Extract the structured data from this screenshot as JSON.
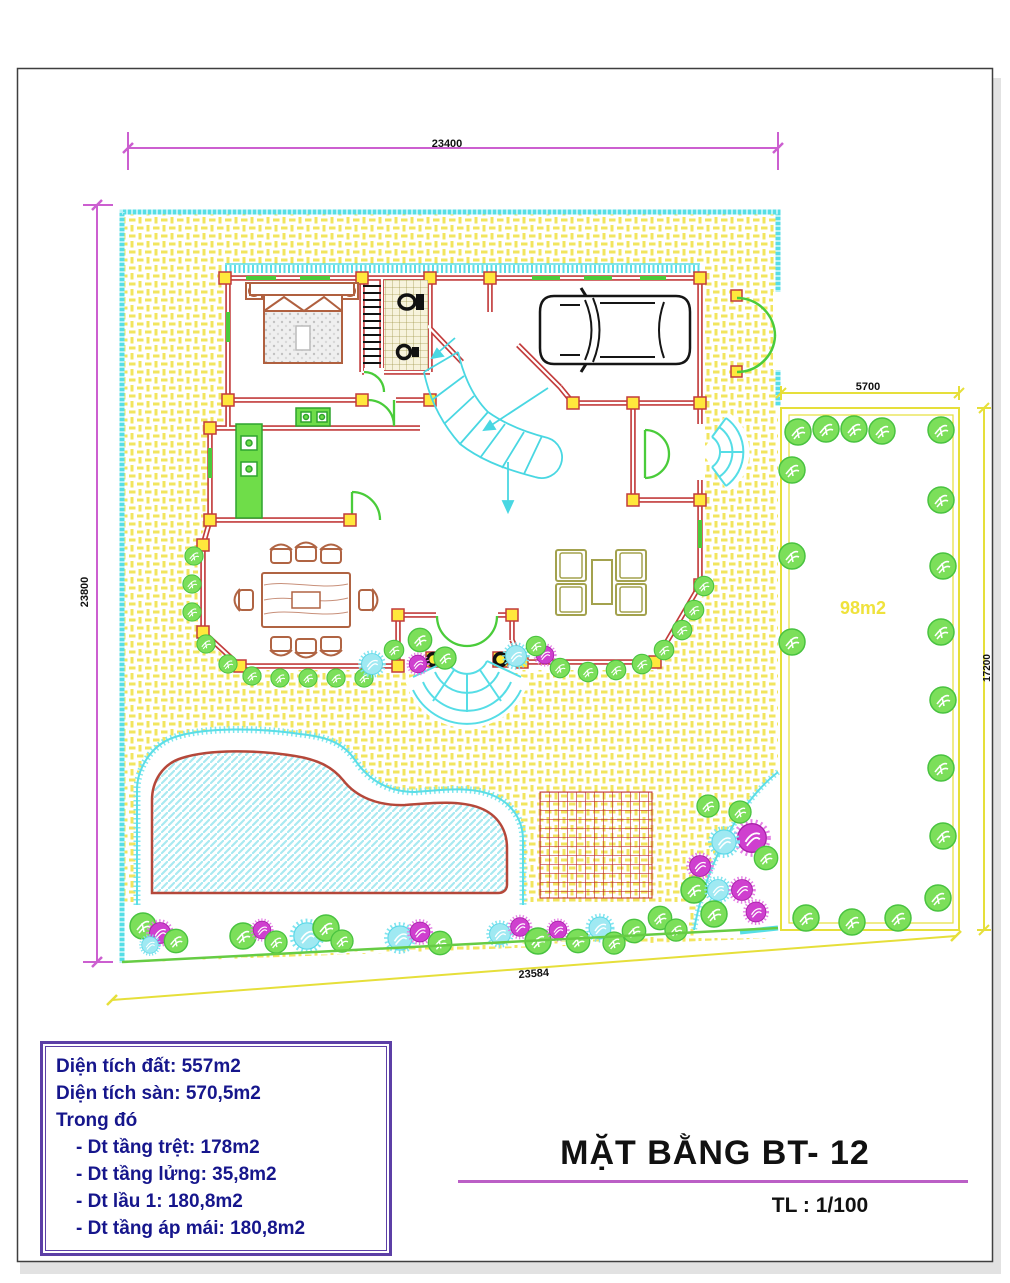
{
  "title_block": {
    "title": "MẶT BẰNG BT- 12",
    "scale": "TL : 1/100"
  },
  "legend": {
    "lines": [
      {
        "text": "Diện tích đất: 557m2",
        "indent": false
      },
      {
        "text": "Diện tích sàn: 570,5m2",
        "indent": false
      },
      {
        "text": "Trong đó",
        "indent": false
      },
      {
        "text": "- Dt tầng trệt: 178m2",
        "indent": true
      },
      {
        "text": "- Dt tầng lửng: 35,8m2",
        "indent": true
      },
      {
        "text": "- Dt lầu 1: 180,8m2",
        "indent": true
      },
      {
        "text": "- Dt tầng áp mái: 180,8m2",
        "indent": true
      }
    ]
  },
  "plan": {
    "garden_area_label": "98m2",
    "dimensions": {
      "site_width_top": "23400",
      "site_height_left": "23800",
      "site_width_bottom": "23584",
      "garden_width_top": "5700",
      "garden_height_right": "17200"
    }
  },
  "colors": {
    "dimension_magenta": "#CC5FD0",
    "dimension_yellow": "#E6DF3A",
    "site_border_cyan": "#55DEE6",
    "wall_red": "#C23B3B",
    "hatch_yellow": "#F2E55E",
    "tree_green": "#7CDF5A",
    "plant_magenta": "#CF3FCF",
    "plant_cyan": "#9FE9F2",
    "furniture_sienna": "#B06443",
    "sofa_khaki": "#A3A24E",
    "legend_text_navy": "#16168C",
    "legend_border_purple": "#5C3FA6",
    "title_underline_magenta": "#BB5FC6",
    "garden_label_yellow": "#EFE23C"
  }
}
